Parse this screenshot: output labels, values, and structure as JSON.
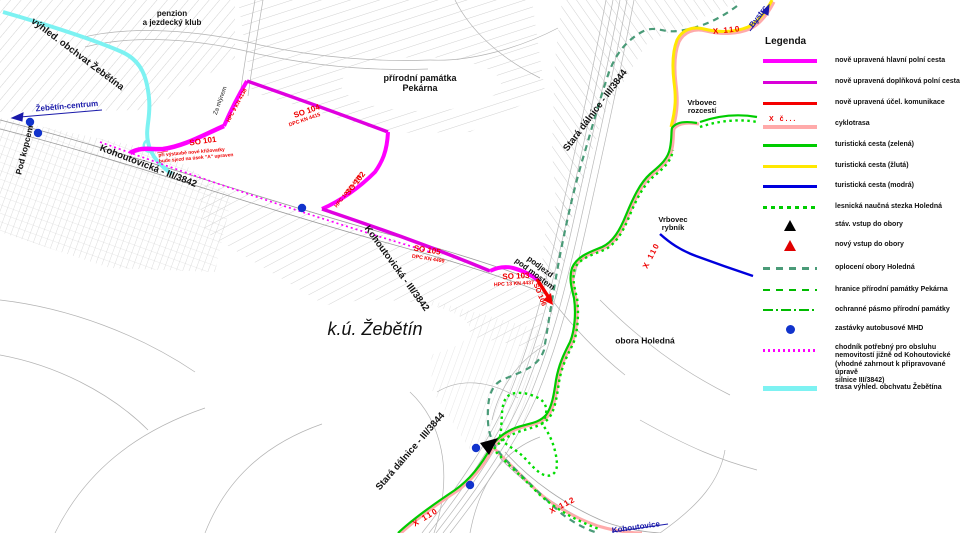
{
  "legend": {
    "title": "Legenda",
    "cyclo_mark": "X č...",
    "items": [
      {
        "label": "nově upravená hlavní polní cesta",
        "color": "#FF00FF"
      },
      {
        "label": "nově upravená doplňková polní cesta",
        "color": "#D900D9"
      },
      {
        "label": "nově upravená účel. komunikace",
        "color": "#F40000"
      },
      {
        "label": "cyklotrasa",
        "color": "#FFAAAA"
      },
      {
        "label": "turistická cesta (zelená)",
        "color": "#00CC00"
      },
      {
        "label": "turistická cesta (žlutá)",
        "color": "#FFE800"
      },
      {
        "label": "turistická cesta (modrá)",
        "color": "#0000DD"
      },
      {
        "label": "lesnická naučná stezka Holedná",
        "color": "#00CC00"
      },
      {
        "label": "stáv. vstup do obory",
        "color": "#000000"
      },
      {
        "label": "nový vstup do obory",
        "color": "#E00000"
      },
      {
        "label": "oplocení obory Holedná",
        "color": "#4A9B78"
      },
      {
        "label": "hranice přírodní památky Pekárna",
        "color": "#00BB00"
      },
      {
        "label": "ochranné pásmo přírodní památky",
        "color": "#00BB00"
      },
      {
        "label": "zastávky autobusové MHD",
        "color": "#1133CC"
      },
      {
        "label": "chodník potřebný pro obsluhu\nnemovitostí jižně od Kohoutovické\n(vhodné zahrnout k připravované úpravě\nsilnice III/3842)",
        "color": "#FF00FF"
      },
      {
        "label": "trasa výhled. obchvatu Žebětína",
        "color": "#7DF2F2"
      }
    ]
  },
  "map": {
    "labels": {
      "vyhled_obchvat": "výhled. obchvat Žebětína",
      "zebetin_centrum": "Žebětín-centrum",
      "pod_kopcem": "Pod kopcem",
      "penzion": "penzion\na jezdecký klub",
      "za_mlynem": "Za mlýnem",
      "pekarna": "přírodní památka\nPekárna",
      "kohoutovicka_1": "Kohoutovická - III/3842",
      "kohoutovicka_2": "Kohoutovická - III/3842",
      "stara_dalnice_1": "Stará dálnice - III/3844",
      "stara_dalnice_2": "Stará dálnice - III/3844",
      "ku_zebetin": "k.ú. Žebětín",
      "obora": "obora Holedná",
      "podjezd": "podjezd\npod mostem",
      "vrbovec_rozcesti": "Vrbovec\nrozcestí",
      "vrbovec_rybnik": "Vrbovec\nrybník",
      "bystrc": "Bystrc",
      "kohoutovice": "Kohoutovice",
      "so101": "SO 101",
      "so101_note": "při výstavbě nové křižovatky\nbude sjezd na úsek \"A\" upraven",
      "so104": "SO 104",
      "so104_sub": "DPC  KN 4415",
      "hpc9": "HPC 9  KN 4138",
      "so102": "SO 102",
      "so102_sub": "HPC 10  KN 4398",
      "so105": "SO 105",
      "so105_sub": "DPC KN 4499",
      "so103": "SO 103",
      "so103_sub": "HPC 13  KN 4437",
      "so106": "SO 106",
      "x110_a": "X  110",
      "x110_b": "X  110",
      "x110_c": "X  110",
      "x112": "X  112"
    }
  }
}
